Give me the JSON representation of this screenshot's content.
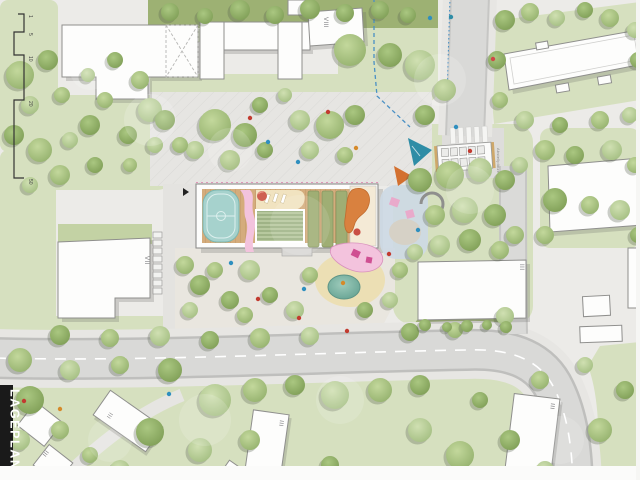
{
  "plan": {
    "sheet_label": "LAGEPLAN",
    "scale_bar": {
      "ticks": [
        "1",
        "5",
        "10",
        "20",
        "50"
      ]
    },
    "storey_labels": {
      "top_center": "VIII",
      "mid_left": "VII",
      "mid_right": "III",
      "bottom_center": "III",
      "bottom_right": "III",
      "bottom_left_a": "III",
      "bottom_left_b": "III"
    },
    "annotations": {
      "bike_parking": "Abstellplätze"
    },
    "colors": {
      "lawn": "#d6e0bf",
      "hedge": "#9db173",
      "road": "#d9d9d7",
      "plaza": "#e6e5e2",
      "building": "#fdfdfc",
      "deck_wood": "#d2a878",
      "court_teal": "#a6d2cd",
      "pond_teal": "#6fae9e",
      "play_pink": "#f3c3dd",
      "slide_orange": "#d9813f",
      "sail_teal": "#2f8da6",
      "boundary_blue": "#4a90c4"
    }
  }
}
